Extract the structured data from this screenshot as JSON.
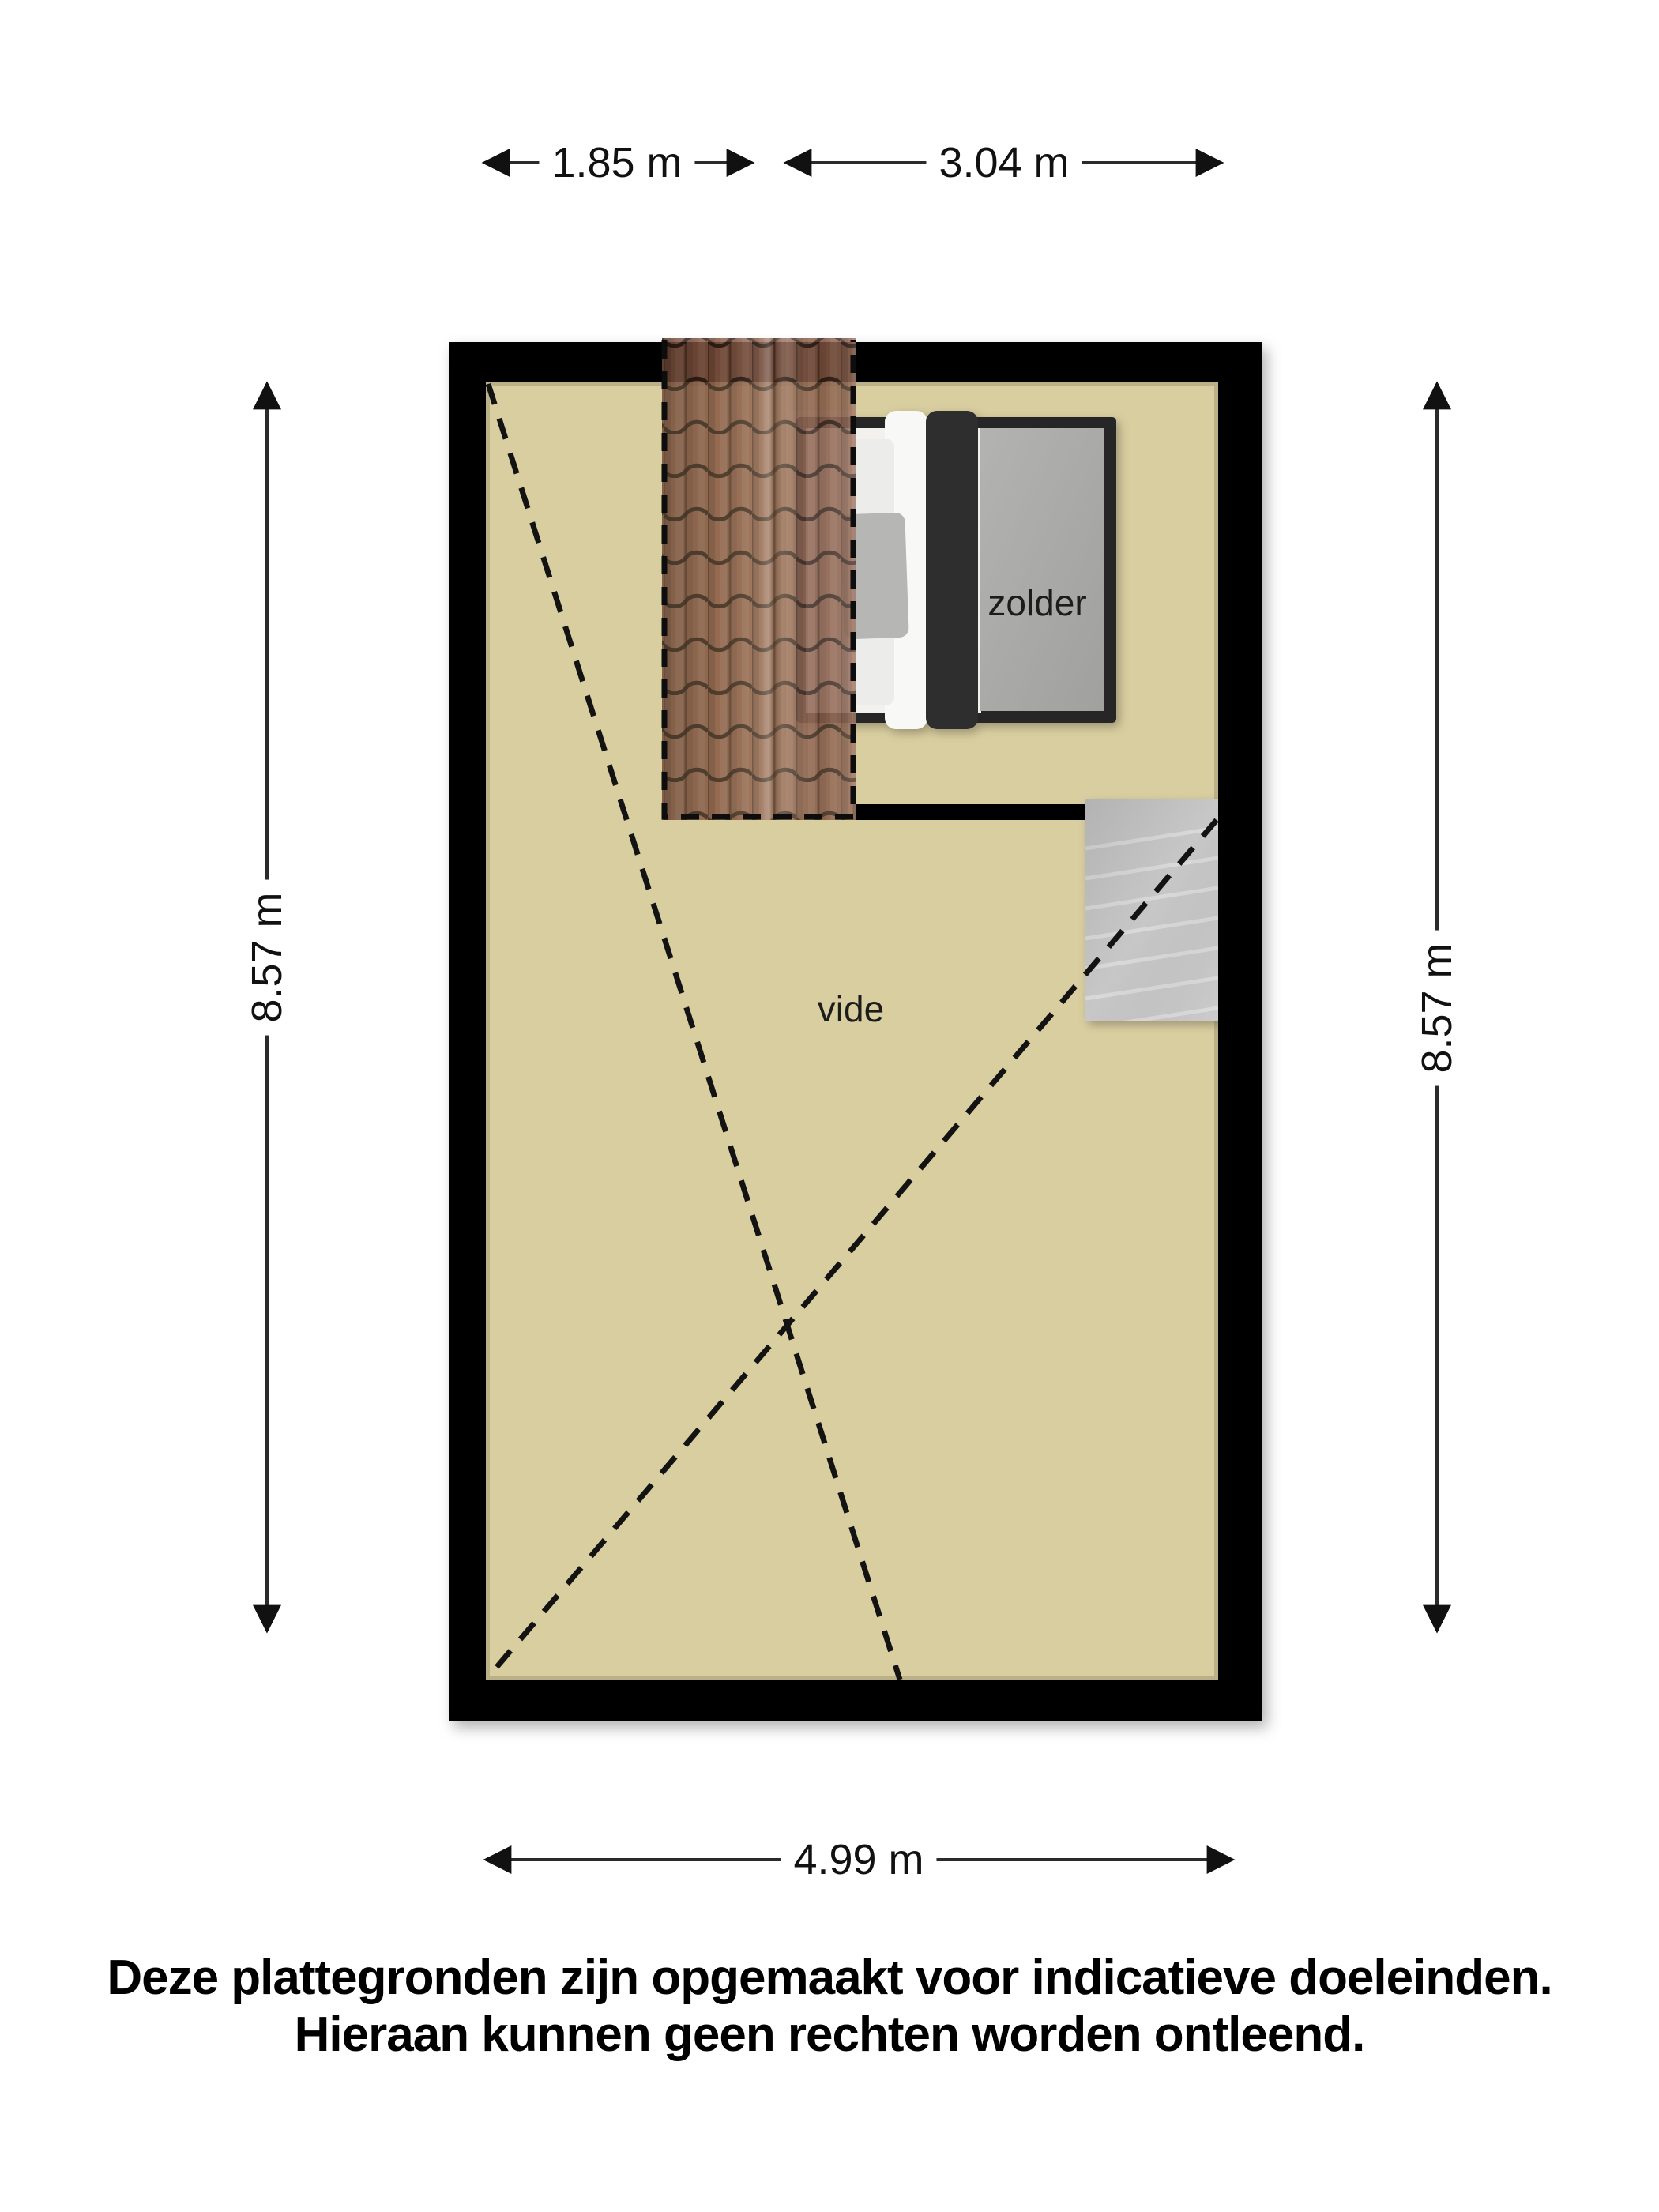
{
  "meta": {
    "type": "floorplan",
    "floor": "zolder"
  },
  "colors": {
    "background": "#ffffff",
    "wall": "#000000",
    "floor": "#d9cea0",
    "roof_tiles": "#8d5c46",
    "roof_tile_lines": "#2a1a12",
    "stairs": "#c7c7c7",
    "bed_frame_dark": "#282828",
    "bed_linen_white": "#f2f1ed",
    "bed_duvet_gray": "#a9a9a9",
    "dashed_line": "#131313",
    "dimension_line": "#2b2b2b",
    "text": "#111111"
  },
  "rooms": [
    {
      "id": "zolder",
      "label": "zolder"
    },
    {
      "id": "vide",
      "label": "vide"
    }
  ],
  "elements": [
    "outer-walls",
    "roof-tile-overlay",
    "double-bed",
    "staircase",
    "sloped-ceiling-dashed-lines"
  ],
  "dimensions": {
    "top": [
      {
        "label": "1.85 m"
      },
      {
        "label": "3.04 m"
      }
    ],
    "bottom": [
      {
        "label": "4.99 m"
      }
    ],
    "left": [
      {
        "label": "8.57 m"
      }
    ],
    "right": [
      {
        "label": "8.57 m"
      }
    ]
  },
  "disclaimer": {
    "line1": "Deze plattegronden zijn opgemaakt voor indicatieve doeleinden.",
    "line2": "Hieraan kunnen geen rechten worden ontleend."
  }
}
